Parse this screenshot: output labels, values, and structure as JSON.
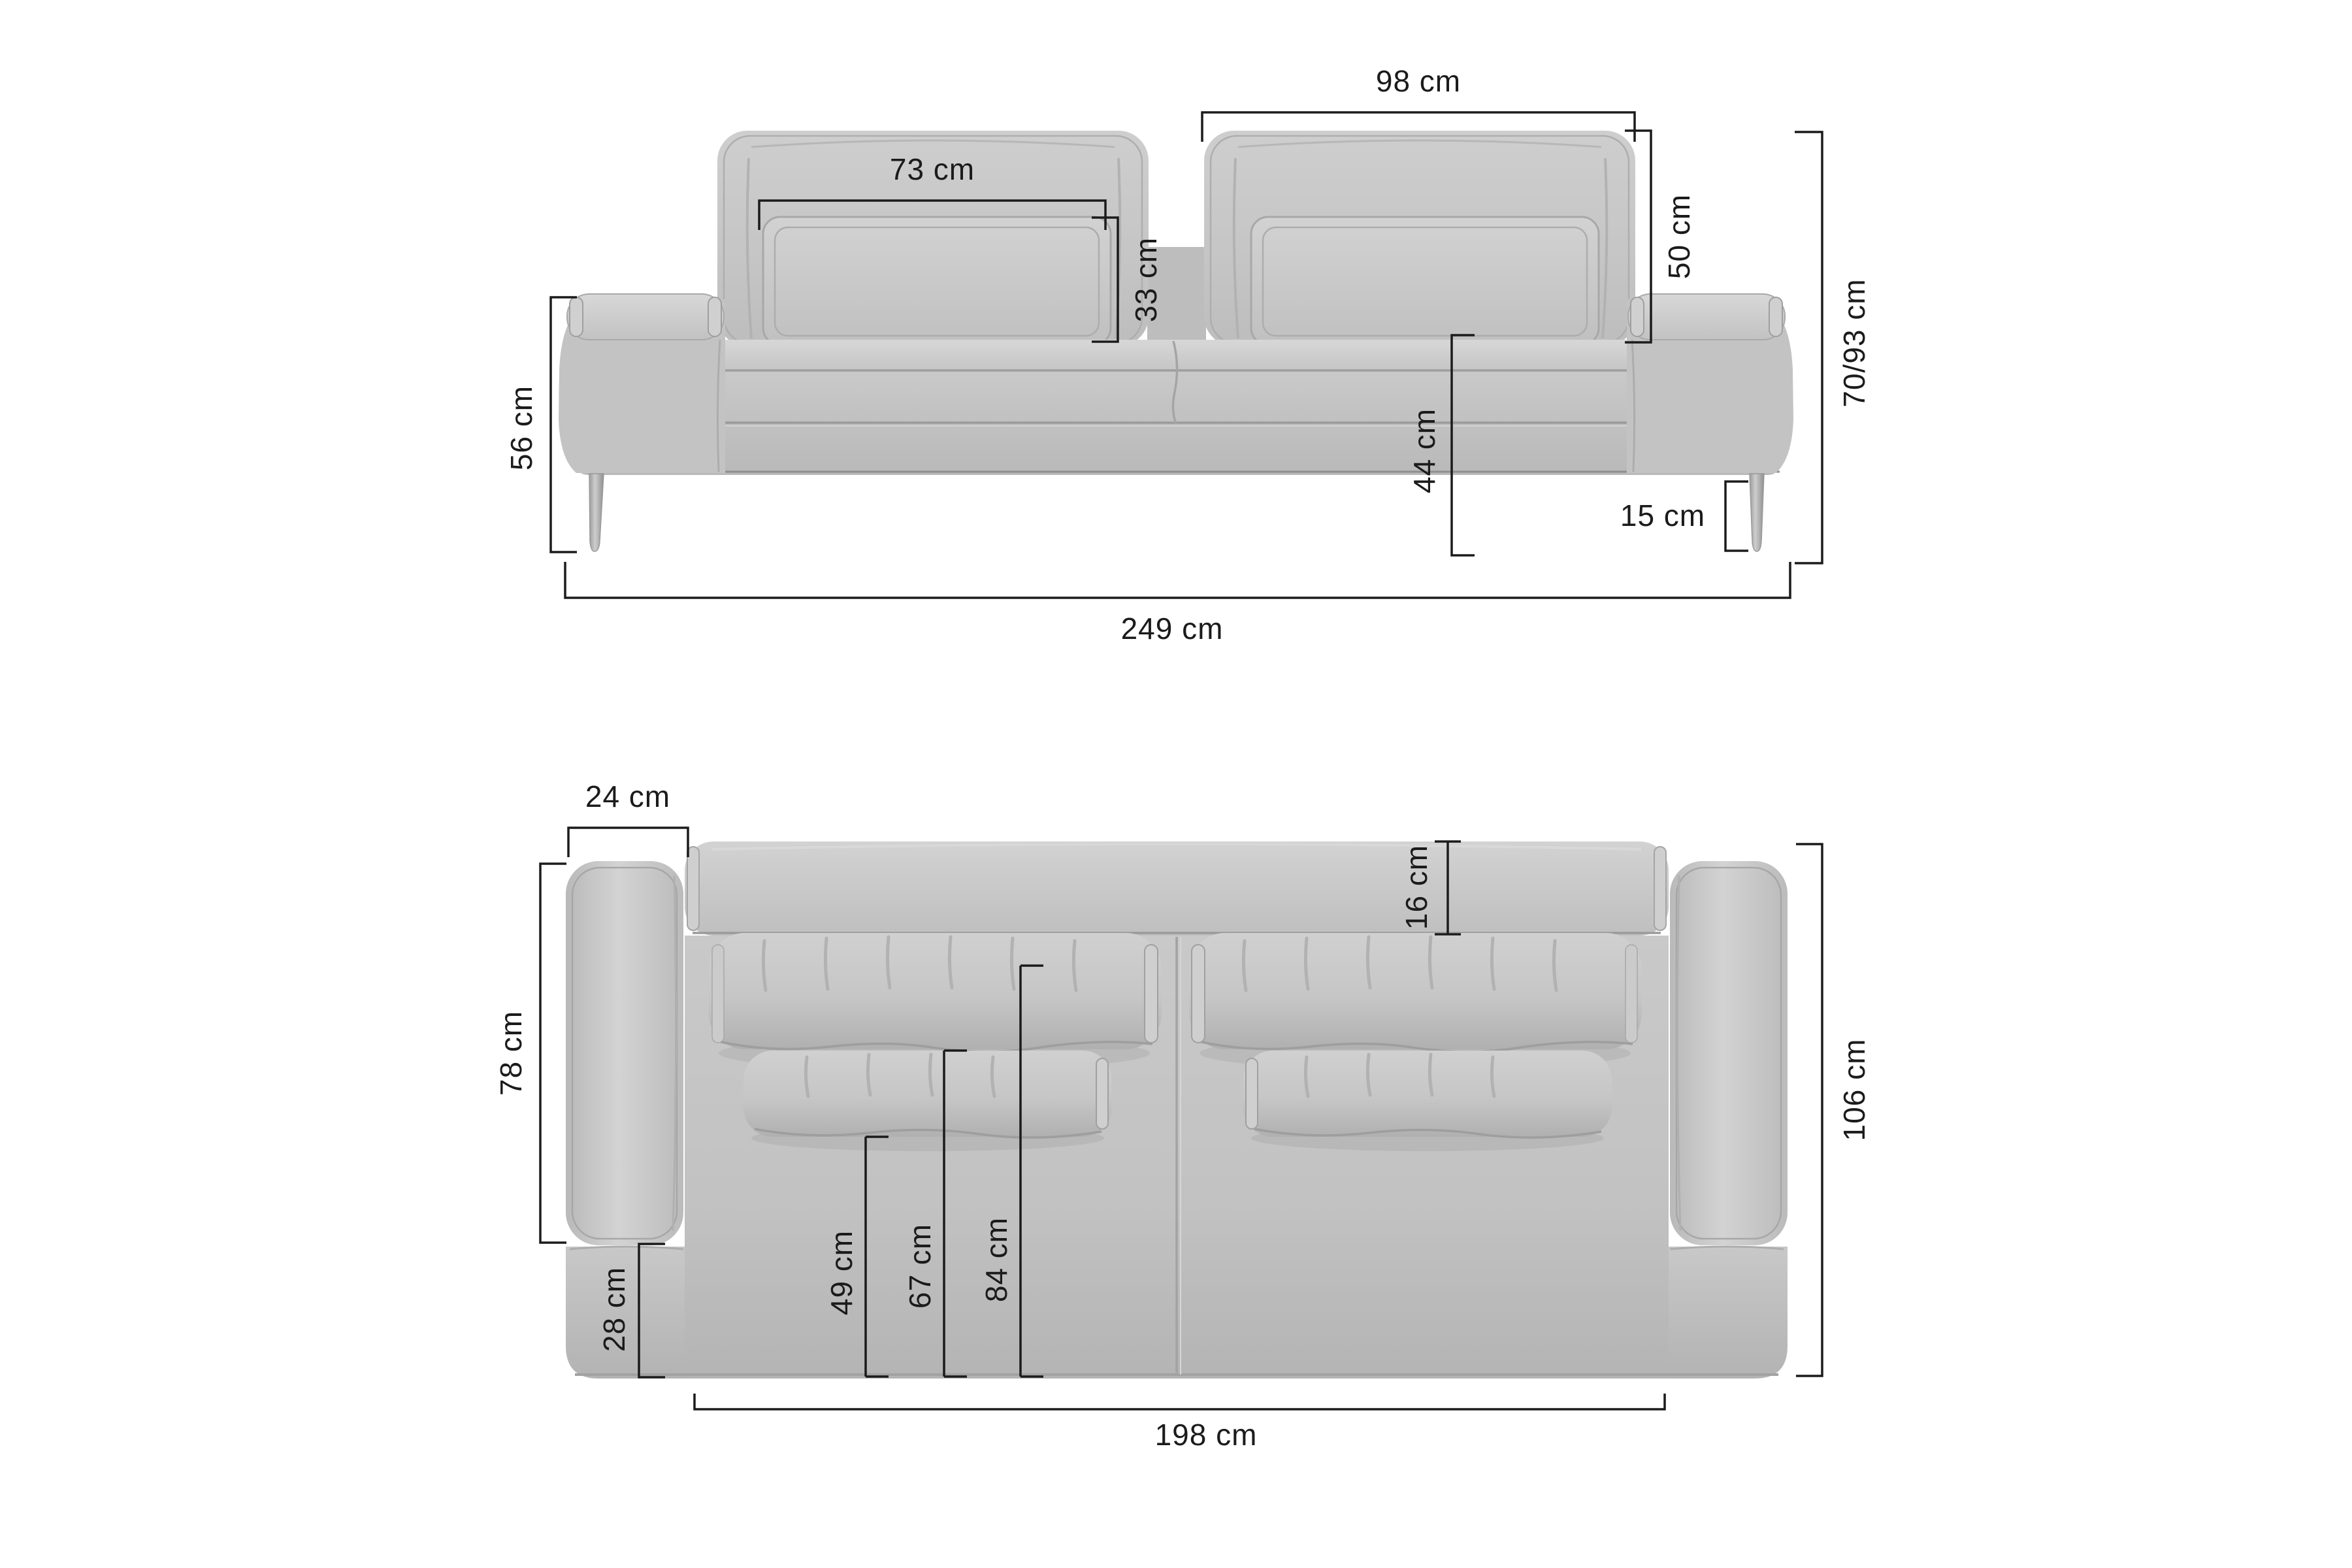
{
  "page": {
    "type": "furniture-dimension-diagram",
    "subject": "three-seat sofa, front elevation and top plan",
    "background": "#ffffff"
  },
  "colors": {
    "dimension_line": "#1b1b1b",
    "sofa_light": "#d6d6d6",
    "sofa_mid": "#c5c5c5",
    "sofa_shadow": "#a9a9a9",
    "leg": "#9c9c9c"
  },
  "front_view": {
    "name": "front elevation",
    "dimensions": {
      "back_cushion_width": "98 cm",
      "lumbar_pillow_width": "73 cm",
      "lumbar_pillow_height": "33 cm",
      "back_cushion_height": "50 cm",
      "overall_height": "70/93 cm",
      "armrest_height": "56 cm",
      "seat_height": "44 cm",
      "leg_height": "15 cm",
      "overall_width": "249 cm"
    }
  },
  "top_view": {
    "name": "top plan",
    "dimensions": {
      "armrest_width": "24 cm",
      "backrest_thickness": "16 cm",
      "armrest_length": "78 cm",
      "overall_depth": "106 cm",
      "front_rail_depth": "28 cm",
      "depth_to_small_pillow": "49 cm",
      "depth_to_back_cushion": "67 cm",
      "usable_seat_depth": "84 cm",
      "seat_width": "198 cm"
    }
  }
}
